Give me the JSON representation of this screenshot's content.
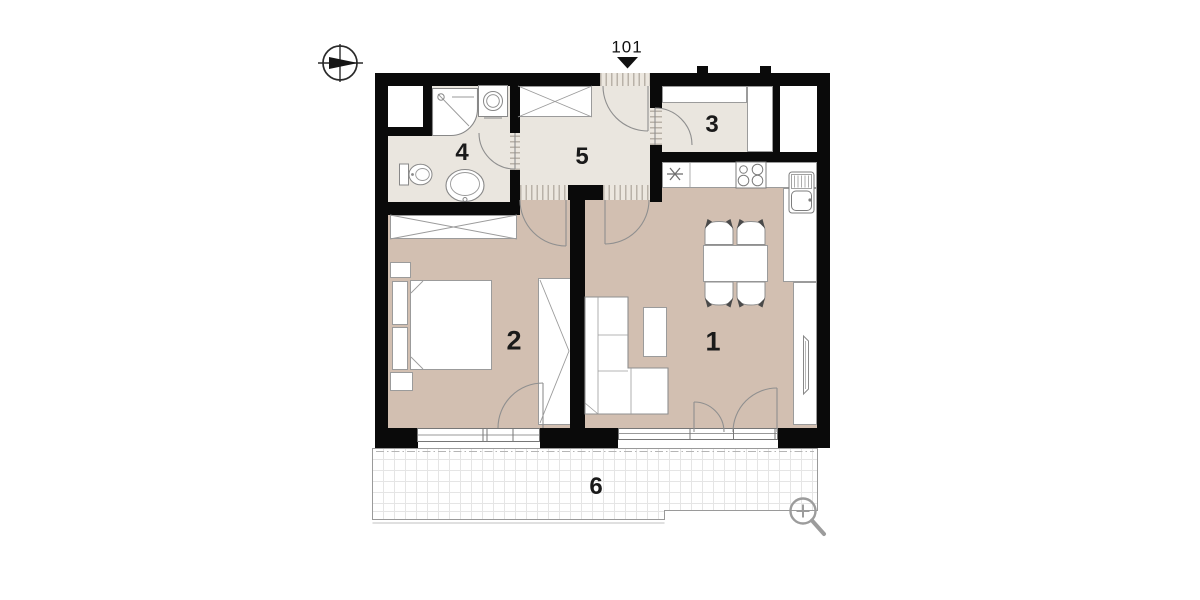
{
  "unit": {
    "label": "101"
  },
  "rooms": [
    {
      "number": "1"
    },
    {
      "number": "2"
    },
    {
      "number": "3"
    },
    {
      "number": "4"
    },
    {
      "number": "5"
    },
    {
      "number": "6"
    }
  ],
  "icons": {
    "compass": "compass-icon",
    "entrance": "entrance-triangle-marker",
    "zoom": "zoom-in-magnifier",
    "appliance": "asterisk-appliance-marker"
  },
  "colors": {
    "wall": "#0a0a0a",
    "floor-main": "#d2bfb1",
    "floor-light": "#eae6df",
    "outline": "#9b9b9b",
    "fixture": "#8f8f8f",
    "balcony-grid": "#e5e5e5",
    "text": "#1a1a1a",
    "icon-gray": "#9c9c9c"
  }
}
